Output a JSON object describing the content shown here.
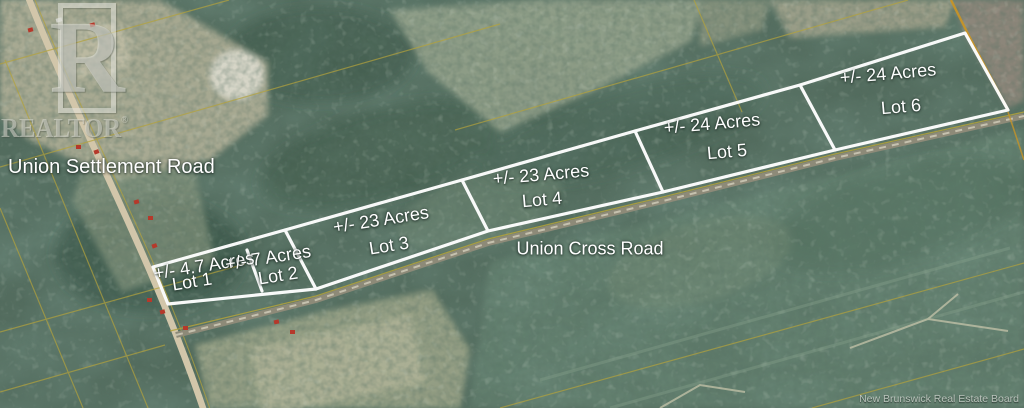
{
  "map": {
    "roads": {
      "settlement": "Union Settlement Road",
      "cross": "Union Cross Road"
    },
    "lots": [
      {
        "acreage": "+/- 4.7 Acres",
        "name": "Lot 1"
      },
      {
        "acreage": "+/- 7 Acres",
        "name": "Lot 2"
      },
      {
        "acreage": "+/- 23 Acres",
        "name": "Lot 3"
      },
      {
        "acreage": "+/- 23 Acres",
        "name": "Lot 4"
      },
      {
        "acreage": "+/- 24 Acres",
        "name": "Lot 5"
      },
      {
        "acreage": "+/- 24 Acres",
        "name": "Lot 6"
      }
    ]
  },
  "watermark": {
    "letter": "R",
    "word": "REALTOR",
    "registered": "®"
  },
  "attribution": "New Brunswick Real Estate Board",
  "colors": {
    "lot_boundary": "#ffffff",
    "cadastral_line": "#b3a23c",
    "highlight_line": "#c69428",
    "label_text": "#ffffff"
  }
}
